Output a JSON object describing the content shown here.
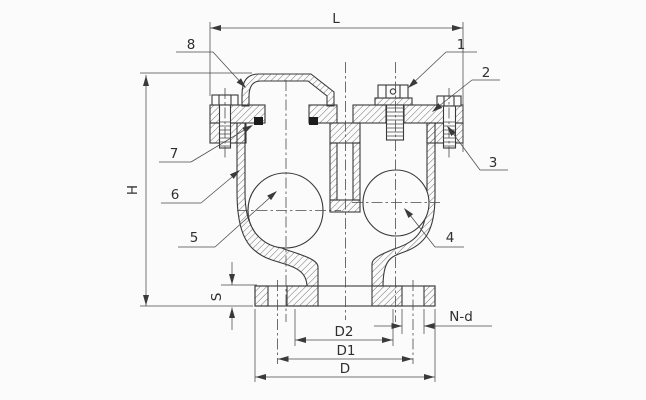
{
  "palette": {
    "line": "#3a3a3a",
    "dim_line": "#4a4a4a",
    "background": "#fbfbfb",
    "seal_fill": "#1c1c1c"
  },
  "dimension_labels": {
    "overall_width": "L",
    "overall_height": "H",
    "flange_thickness": "S",
    "raised_face": "D2",
    "bolt_circle": "D1",
    "flange_od": "D",
    "bolt_holes": "N-d"
  },
  "callouts": {
    "c1": "1",
    "c2": "2",
    "c3": "3",
    "c4": "4",
    "c5": "5",
    "c6": "6",
    "c7": "7",
    "c8": "8"
  }
}
